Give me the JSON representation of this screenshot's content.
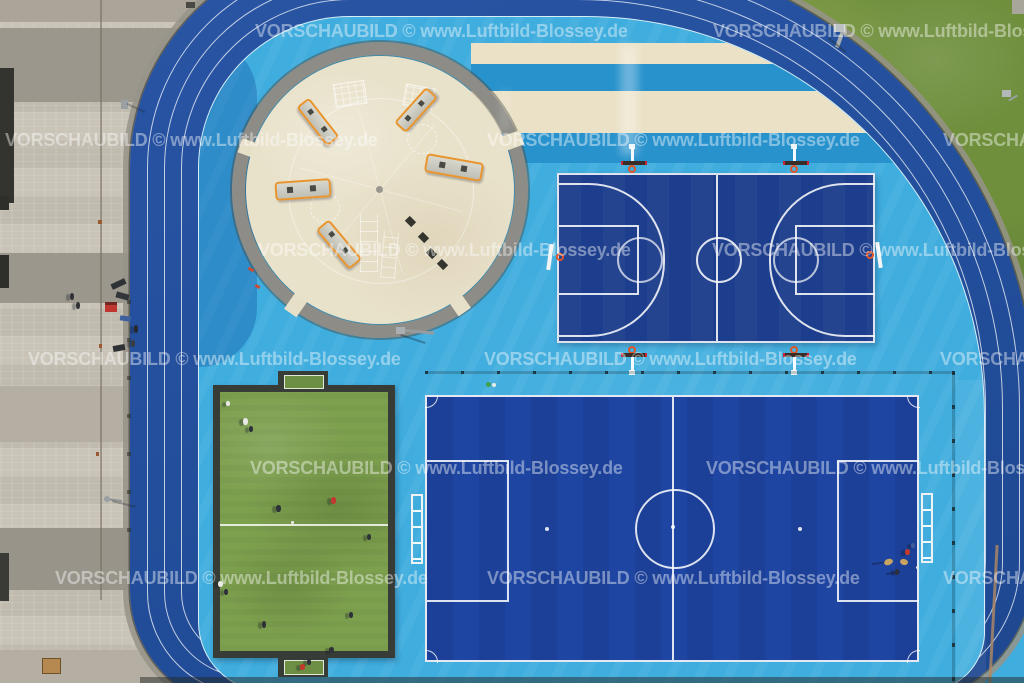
{
  "watermark": {
    "text": "VORSCHAUBILD © www.Luftbild-Blossey.de",
    "color": "#ffffff",
    "opacity": 0.42
  },
  "palette": {
    "track_blue": "#234f9d",
    "infield_cyan": "#3fadde",
    "stripe_blue": "#2892cc",
    "stripe_beige": "#eae1c6",
    "basketball_court_blue": "#1d3e8c",
    "soccer_field_blue": "#1e45a2",
    "mini_pitch_turf_green": "#7da04e",
    "lawn_green": "#6f8f3d",
    "plaza_beige": "#e9e2cb",
    "plaza_ring_gray": "#8d8c86",
    "pavement_gray": "#c9c4b7",
    "equipment_orange": "#e8952f",
    "line_white": "#ffffff",
    "goal_frame_white": "#eef2f5",
    "hoop_rim_orange": "#e05528"
  }
}
